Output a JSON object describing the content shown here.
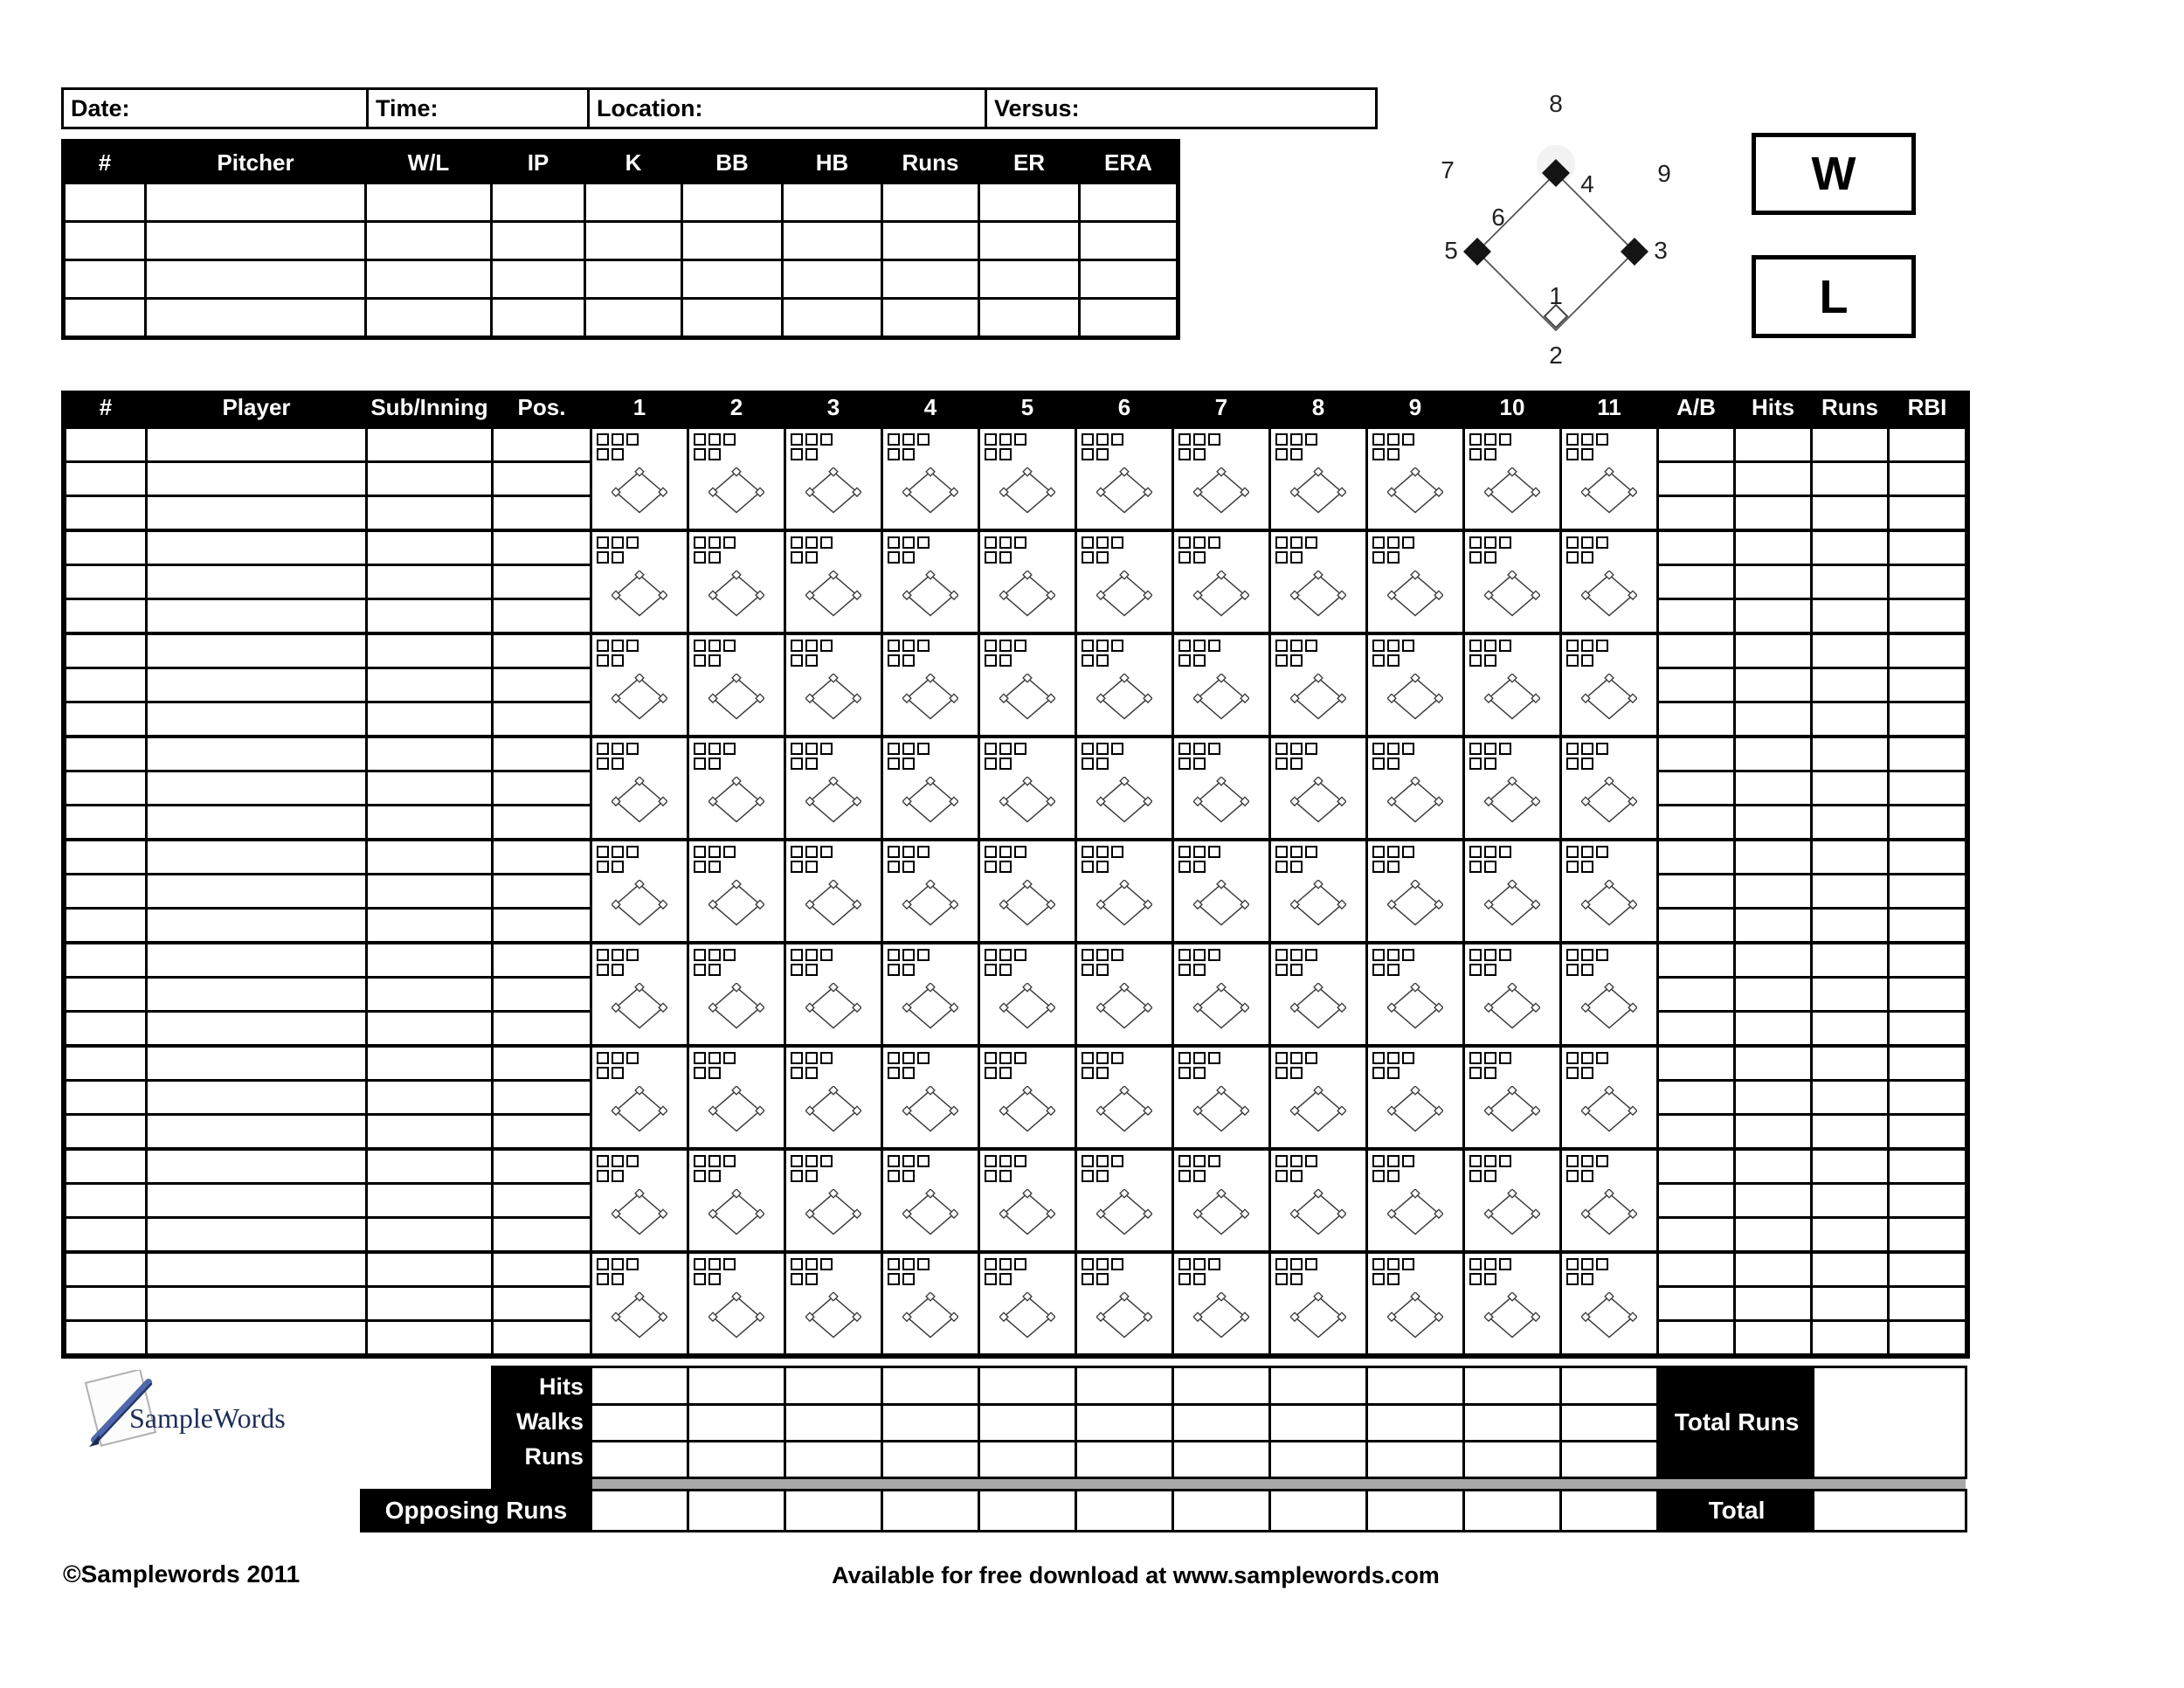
{
  "game_info": {
    "date_label": "Date:",
    "time_label": "Time:",
    "location_label": "Location:",
    "versus_label": "Versus:"
  },
  "pitcher_table": {
    "headers": [
      "#",
      "Pitcher",
      "W/L",
      "IP",
      "K",
      "BB",
      "HB",
      "Runs",
      "ER",
      "ERA"
    ],
    "data_rows": 4
  },
  "field_diagram": {
    "pos1": "1",
    "pos2": "2",
    "pos3": "3",
    "pos4": "4",
    "pos5": "5",
    "pos6": "6",
    "pos7": "7",
    "pos8": "8",
    "pos9": "9",
    "win_label": "W",
    "loss_label": "L"
  },
  "scoring_grid": {
    "col_headers": [
      "#",
      "Player",
      "Sub/Inning",
      "Pos.",
      "1",
      "2",
      "3",
      "4",
      "5",
      "6",
      "7",
      "8",
      "9",
      "10",
      "11",
      "A/B",
      "Hits",
      "Runs",
      "RBI"
    ],
    "player_blocks": 9,
    "innings": 11,
    "sub_rows_per_block": 3,
    "pitch_boxes_top_row": 3,
    "pitch_boxes_bottom_row": 2
  },
  "summary": {
    "row_labels": [
      "Hits",
      "Walks",
      "Runs"
    ],
    "opposing_runs_label": "Opposing Runs",
    "total_runs_label": "Total Runs",
    "total_label": "Total"
  },
  "branding": {
    "logo_text": "SampleWords",
    "copyright": "©Samplewords 2011",
    "download_note": "Available for free download at www.samplewords.com"
  },
  "colors": {
    "header_bg": "#000000",
    "header_text": "#ffffff",
    "grid_line": "#000000",
    "gray_bar": "#a8a8a8",
    "logo_navy": "#1d2d56",
    "logo_pen_blue": "#4f67ab",
    "diamond_line": "#3c3c3c"
  }
}
